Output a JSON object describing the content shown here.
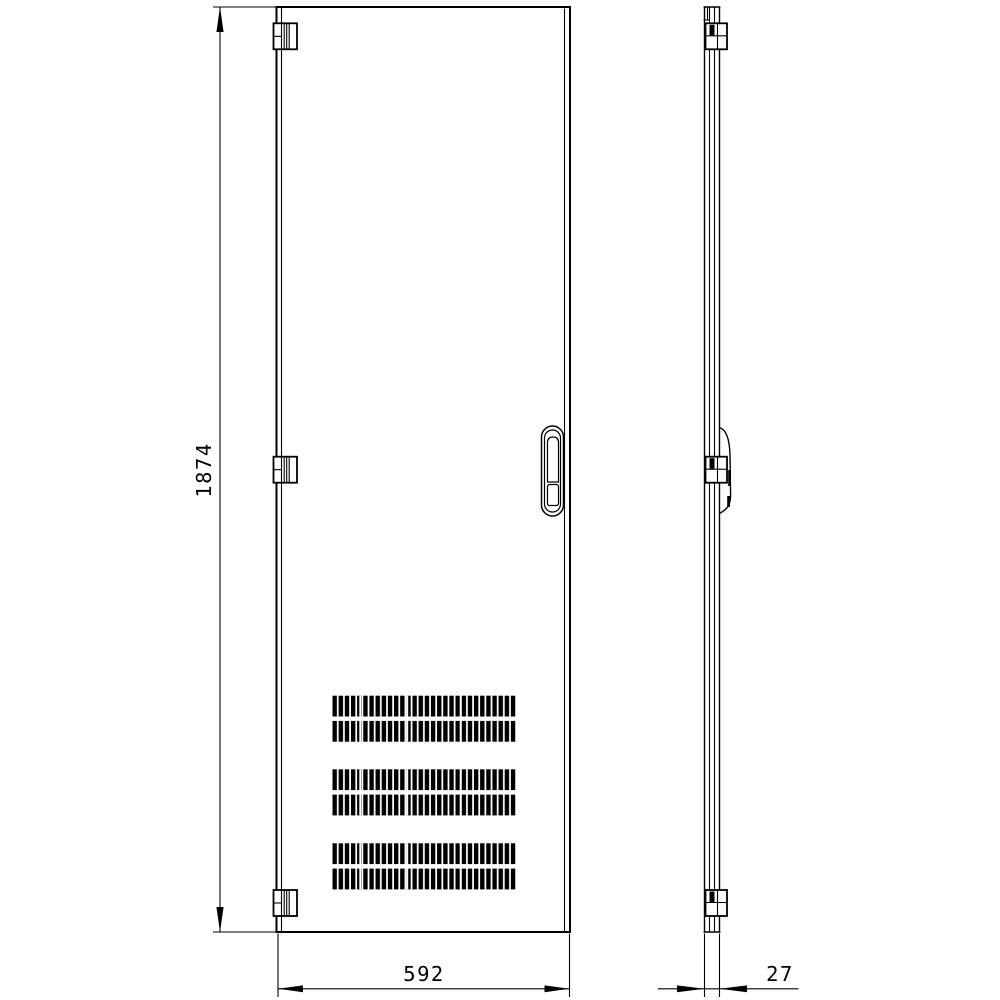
{
  "drawing": {
    "type": "technical-drawing",
    "colors": {
      "line": "#000000",
      "background": "#ffffff"
    },
    "dimensions": {
      "height": "1874",
      "width": "592",
      "depth": "27"
    },
    "parts": {
      "front_view": "vented door front elevation",
      "side_view": "door side profile",
      "hinges": 3,
      "vent_rows": 6,
      "handle": "recessed swing handle with lock"
    }
  }
}
